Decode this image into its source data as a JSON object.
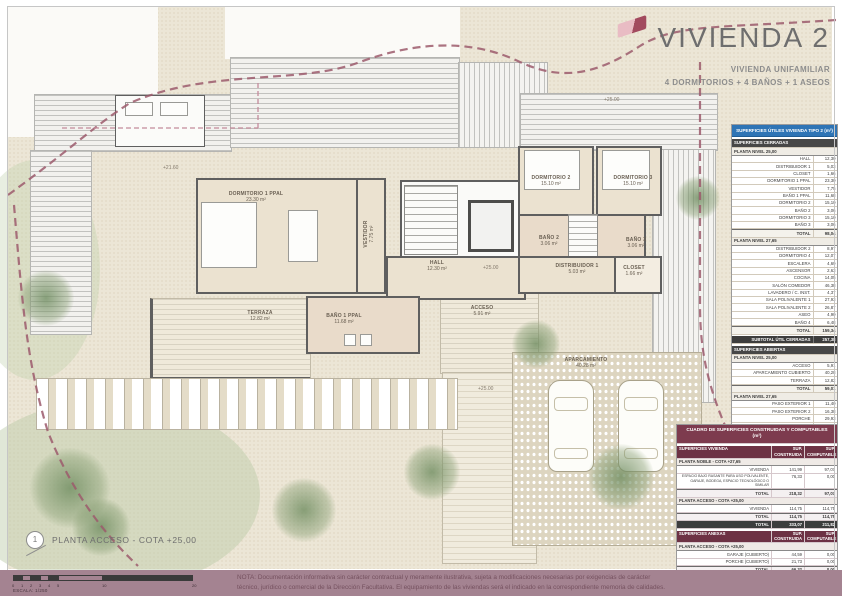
{
  "title": {
    "main": "VIVIENDA 2",
    "sub1": "VIVIENDA UNIFAMILIAR",
    "sub2": "4 DORMITORIOS + 4 BAÑOS + 1 ASEOS"
  },
  "drawing": {
    "name": "PLANTA ACCESO - COTA +25,00",
    "marker": "1",
    "scale_label": "ESCALA: 1/250",
    "scale_segments": [
      {
        "x": 0,
        "w": 9,
        "f": 1
      },
      {
        "x": 9,
        "w": 9,
        "f": 0
      },
      {
        "x": 18,
        "w": 9,
        "f": 1
      },
      {
        "x": 27,
        "w": 9,
        "f": 0
      },
      {
        "x": 36,
        "w": 9,
        "f": 1
      },
      {
        "x": 45,
        "w": 45,
        "f": 0
      },
      {
        "x": 90,
        "w": 90,
        "f": 1
      }
    ],
    "scale_ticks": [
      {
        "t": "0",
        "x": 0
      },
      {
        "t": "1",
        "x": 9
      },
      {
        "t": "2",
        "x": 18
      },
      {
        "t": "3",
        "x": 27
      },
      {
        "t": "4",
        "x": 36
      },
      {
        "t": "5",
        "x": 45
      },
      {
        "t": "10",
        "x": 90
      },
      {
        "t": "20",
        "x": 180
      }
    ]
  },
  "note": {
    "line1": "NOTA: Documentación informativa sin carácter contractual y meramente ilustrativa, sujeta a modificaciones necesarias por exigencias de carácter",
    "line2": "técnico, jurídico o comercial de la Dirección Facultativa. El equipamiento de las viviendas será el indicado en la correspondiente memoria de calidades."
  },
  "plan": {
    "labels": [
      {
        "name": "DORMITORIO 1 PPAL",
        "area": "23.30 m²",
        "x": 256,
        "y": 191,
        "w": 92
      },
      {
        "name": "VESTIDOR",
        "area": "7.75 m²",
        "x": 369,
        "y": 228,
        "w": 60,
        "v": 1
      },
      {
        "name": "HALL",
        "area": "12.30 m²",
        "x": 437,
        "y": 260,
        "w": 60
      },
      {
        "name": "DORMITORIO 2",
        "area": "15.10 m²",
        "x": 551,
        "y": 175,
        "w": 70
      },
      {
        "name": "DORMITORIO 3",
        "area": "15.10 m²",
        "x": 633,
        "y": 175,
        "w": 70
      },
      {
        "name": "BAÑO 2",
        "area": "3.06 m²",
        "x": 549,
        "y": 235,
        "w": 50
      },
      {
        "name": "BAÑO 3",
        "area": "3.06 m²",
        "x": 636,
        "y": 237,
        "w": 50
      },
      {
        "name": "DISTRIBUIDOR 1",
        "area": "5.03 m²",
        "x": 577,
        "y": 263,
        "w": 72
      },
      {
        "name": "CLOSET",
        "area": "1.66 m²",
        "x": 634,
        "y": 265,
        "w": 50
      },
      {
        "name": "TERRAZA",
        "area": "12.82 m²",
        "x": 260,
        "y": 310,
        "w": 60
      },
      {
        "name": "BAÑO 1 PPAL",
        "area": "11.68 m²",
        "x": 344,
        "y": 313,
        "w": 70
      },
      {
        "name": "ACCESO",
        "area": "5.91 m²",
        "x": 482,
        "y": 305,
        "w": 52
      },
      {
        "name": "APARCAMIENTO",
        "area": "40.28 m²",
        "x": 586,
        "y": 357,
        "w": 80
      }
    ],
    "levels": [
      {
        "text": "+21.60",
        "x": 163,
        "y": 165
      },
      {
        "text": "+25.00",
        "x": 604,
        "y": 97
      },
      {
        "text": "+25.00",
        "x": 483,
        "y": 265
      },
      {
        "text": "+25.00",
        "x": 478,
        "y": 386
      }
    ]
  },
  "tables": {
    "utiles": {
      "rows": [
        {
          "t": "head",
          "l": "SUPERFICIES ÚTILES VIVIENDA TIPO 2 (m²)"
        },
        {
          "t": "sec",
          "l": "SUPERFICIES CERRADAS"
        },
        {
          "t": "sub",
          "l": "PLANTA NIVEL 25,00"
        },
        {
          "t": "row",
          "l": "HALL",
          "v": "12,30"
        },
        {
          "t": "row",
          "l": "DISTRIBUIDOR 1",
          "v": "5,03"
        },
        {
          "t": "row",
          "l": "CLOSET",
          "v": "1,66"
        },
        {
          "t": "row",
          "l": "DORMITORIO 1 PPAL",
          "v": "23,30"
        },
        {
          "t": "row",
          "l": "VESTIDOR",
          "v": "7,75"
        },
        {
          "t": "row",
          "l": "BAÑO 1 PPAL",
          "v": "11,68"
        },
        {
          "t": "row",
          "l": "DORMITORIO 2",
          "v": "15,10"
        },
        {
          "t": "row",
          "l": "BAÑO 2",
          "v": "3,06"
        },
        {
          "t": "row",
          "l": "DORMITORIO 3",
          "v": "15,10"
        },
        {
          "t": "row",
          "l": "BAÑO 3",
          "v": "3,06"
        },
        {
          "t": "tot",
          "l": "TOTAL",
          "v": "98,04"
        },
        {
          "t": "sub",
          "l": "PLANTA NIVEL 27,65"
        },
        {
          "t": "row",
          "l": "DISTRIBUIDOR 2",
          "v": "8,97"
        },
        {
          "t": "row",
          "l": "DORMITORIO 4",
          "v": "12,07"
        },
        {
          "t": "row",
          "l": "ESCALERA",
          "v": "4,69"
        },
        {
          "t": "row",
          "l": "ASCENSOR",
          "v": "2,63"
        },
        {
          "t": "row",
          "l": "COCINA",
          "v": "14,05"
        },
        {
          "t": "row",
          "l": "SALÓN COMEDOR",
          "v": "46,38"
        },
        {
          "t": "row",
          "l": "LAVADERO / C. INST.",
          "v": "4,37"
        },
        {
          "t": "row",
          "l": "SALA POLIVALENTE 1",
          "v": "27,93"
        },
        {
          "t": "row",
          "l": "SALA POLIVALENTE 2",
          "v": "26,87"
        },
        {
          "t": "row",
          "l": "ASEO",
          "v": "4,90"
        },
        {
          "t": "row",
          "l": "BAÑO 4",
          "v": "6,48"
        },
        {
          "t": "tot",
          "l": "TOTAL",
          "v": "159,34"
        },
        {
          "t": "dark",
          "l": "SUBTOTAL ÚTIL CERRADAS",
          "v": "257,38"
        },
        {
          "t": "sec",
          "l": "SUPERFICIES ABIERTAS"
        },
        {
          "t": "sub",
          "l": "PLANTA NIVEL 25,00"
        },
        {
          "t": "row",
          "l": "ACCESO",
          "v": "5,91"
        },
        {
          "t": "row",
          "l": "APARCAMIENTO CUBIERTO",
          "v": "40,28"
        },
        {
          "t": "row",
          "l": "TERRAZA",
          "v": "12,82"
        },
        {
          "t": "tot",
          "l": "TOTAL",
          "v": "59,01"
        },
        {
          "t": "sub",
          "l": "PLANTA NIVEL 27,65"
        },
        {
          "t": "row",
          "l": "PASO EXTERIOR 1",
          "v": "11,40"
        },
        {
          "t": "row",
          "l": "PASO EXTERIOR 2",
          "v": "16,38"
        },
        {
          "t": "row",
          "l": "PORCHE",
          "v": "29,93"
        },
        {
          "t": "row",
          "l": "PORCHE PASO 2",
          "v": "4,80"
        },
        {
          "t": "tot",
          "l": "TOTAL",
          "v": "62,51"
        },
        {
          "t": "dark",
          "l": "SUBTOTAL ÚTIL ABIERTAS",
          "v": "121,52"
        },
        {
          "t": "grand",
          "l": "TOTAL SUPERFICIE ÚTIL",
          "v": "378,90"
        }
      ]
    },
    "construidas": {
      "rows": [
        {
          "t": "head",
          "l": "CUADRO DE SUPERFICIES CONSTRUIDAS Y COMPUTABLES (m²)"
        },
        {
          "t": "cols",
          "c": [
            "SUPERFICIES VIVIENDA",
            "SUP. CONSTRUIDA",
            "SUP. COMPUTABLE"
          ]
        },
        {
          "t": "sub",
          "l": "PLANTA NOBLE - COTA +27,65"
        },
        {
          "t": "row",
          "c": [
            "VIVIENDA",
            "141,99",
            "97,07"
          ]
        },
        {
          "t": "row",
          "s": 1,
          "c": [
            "ESPACIO BAJO RASANTE PARA USO POLIVALENTE, GARAJE, BODEGA, ESPACIO TECNOLÓGICO O SIMILAR",
            "76,33",
            "0,00"
          ]
        },
        {
          "t": "tot",
          "c": [
            "TOTAL",
            "218,32",
            "97,07"
          ]
        },
        {
          "t": "sub",
          "l": "PLANTA ACCESO - COTA +25,00"
        },
        {
          "t": "row",
          "c": [
            "VIVIENDA",
            "114,75",
            "114,75"
          ]
        },
        {
          "t": "tot",
          "c": [
            "TOTAL",
            "114,75",
            "114,75"
          ]
        },
        {
          "t": "dark",
          "c": [
            "TOTAL",
            "333,07",
            "211,82"
          ]
        },
        {
          "t": "cols",
          "c": [
            "SUPERFICIES ANEXAS",
            "SUP. CONSTRUIDA",
            "SUP. COMPUTABLE"
          ]
        },
        {
          "t": "sub",
          "l": "PLANTA ACCESO - COTA +25,00"
        },
        {
          "t": "row",
          "c": [
            "GARAJE (CUBIERTO)",
            "44,59",
            "0,00"
          ]
        },
        {
          "t": "row",
          "c": [
            "PORCHE (CUBIERTO)",
            "21,73",
            "0,00"
          ]
        },
        {
          "t": "tot",
          "c": [
            "TOTAL",
            "66,32",
            "0,00"
          ]
        },
        {
          "t": "dark",
          "c": [
            "TOTAL",
            "66,32",
            "0,00"
          ]
        },
        {
          "t": "grand",
          "c": [
            "TOTAL SUPERFICIE",
            "399,39",
            "211,82"
          ]
        },
        {
          "t": "foot",
          "l": "* Superficie construida con parte proporcional de elementos comunes."
        },
        {
          "t": "foot",
          "l": "** Superficie computable según normativa urbanística de aplicación."
        }
      ]
    }
  },
  "colors": {
    "accent_blue": "#2e74b5",
    "maroon": "#7d3b4e",
    "footer_band": "#a48391",
    "boundary_dash": "#9c5a6c",
    "wall": "#5f5f5f",
    "room_fill": "#ebe2d0"
  }
}
